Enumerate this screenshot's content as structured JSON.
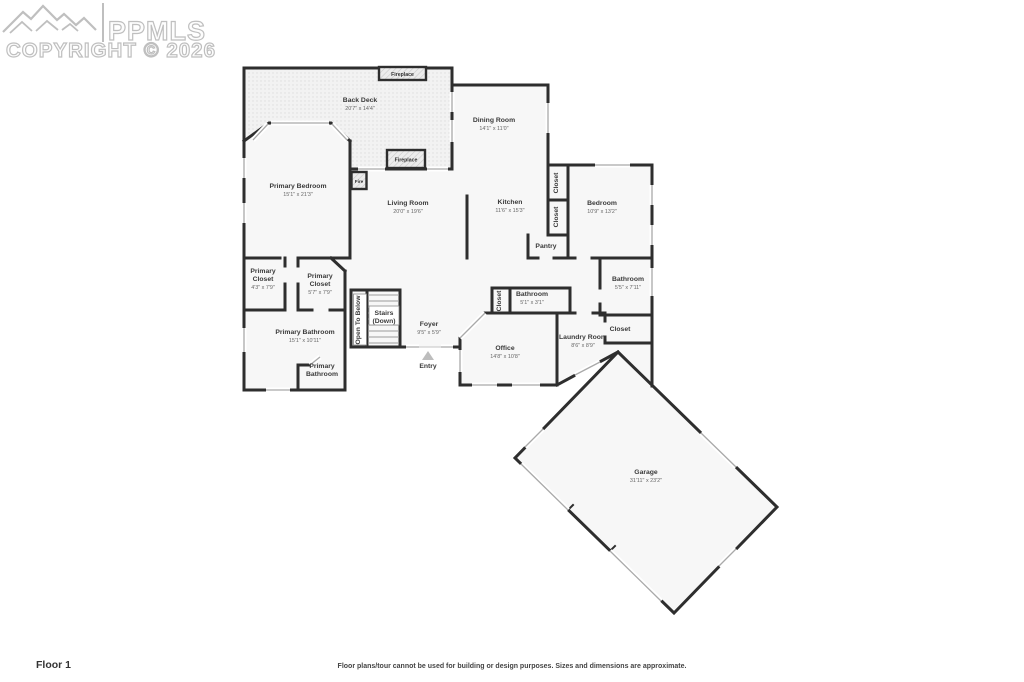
{
  "watermark": {
    "logo_text": "PPMLS",
    "copyright": "COPYRIGHT © 2026"
  },
  "footer": {
    "floor_label": "Floor 1",
    "disclaimer": "Floor plans/tour cannot be used for building or design purposes. Sizes and dimensions are approximate."
  },
  "features": [
    {
      "id": "fireplace-deck",
      "label": "Fireplace"
    },
    {
      "id": "fireplace-living",
      "label": "Fireplace"
    },
    {
      "id": "primary-bedroom-fireplace",
      "label": "Fire"
    }
  ],
  "rooms": [
    {
      "id": "back-deck",
      "x": 360,
      "y": 102,
      "lines": [
        {
          "t": "Back Deck"
        },
        {
          "t": "20'7\" x 14'4\"",
          "d": 1
        }
      ]
    },
    {
      "id": "dining-room",
      "x": 494,
      "y": 122,
      "lines": [
        {
          "t": "Dining Room"
        },
        {
          "t": "14'1\" x 11'0\"",
          "d": 1
        }
      ]
    },
    {
      "id": "primary-bedroom",
      "x": 298,
      "y": 188,
      "lines": [
        {
          "t": "Primary Bedroom"
        },
        {
          "t": "15'1\" x 21'3\"",
          "d": 1
        }
      ]
    },
    {
      "id": "living-room",
      "x": 408,
      "y": 205,
      "lines": [
        {
          "t": "Living Room"
        },
        {
          "t": "20'0\" x 19'6\"",
          "d": 1
        }
      ]
    },
    {
      "id": "kitchen",
      "x": 510,
      "y": 204,
      "lines": [
        {
          "t": "Kitchen"
        },
        {
          "t": "11'6\" x 15'3\"",
          "d": 1
        }
      ]
    },
    {
      "id": "kitchen-closet-upper",
      "x": 558,
      "y": 183,
      "v": 1,
      "lines": [
        {
          "t": "Closet"
        }
      ]
    },
    {
      "id": "kitchen-closet-lower",
      "x": 558,
      "y": 217,
      "v": 1,
      "lines": [
        {
          "t": "Closet"
        }
      ]
    },
    {
      "id": "pantry",
      "x": 546,
      "y": 248,
      "lines": [
        {
          "t": "Pantry"
        }
      ]
    },
    {
      "id": "bedroom",
      "x": 602,
      "y": 205,
      "lines": [
        {
          "t": "Bedroom"
        },
        {
          "t": "10'9\" x 13'2\"",
          "d": 1
        }
      ]
    },
    {
      "id": "bathroom-right",
      "x": 628,
      "y": 281,
      "lines": [
        {
          "t": "Bathroom"
        },
        {
          "t": "5'5\" x 7'11\"",
          "d": 1
        }
      ]
    },
    {
      "id": "closet-right",
      "x": 620,
      "y": 331,
      "lines": [
        {
          "t": "Closet"
        }
      ]
    },
    {
      "id": "primary-closet-left",
      "x": 263,
      "y": 273,
      "lines": [
        {
          "t": "Primary"
        },
        {
          "t": "Closet"
        },
        {
          "t": "4'3\" x 7'9\"",
          "d": 1
        }
      ]
    },
    {
      "id": "primary-closet-right",
      "x": 320,
      "y": 278,
      "lines": [
        {
          "t": "Primary"
        },
        {
          "t": "Closet"
        },
        {
          "t": "5'7\" x 7'9\"",
          "d": 1
        }
      ]
    },
    {
      "id": "open-to-below",
      "x": 360,
      "y": 320,
      "v": 1,
      "lines": [
        {
          "t": "Open To Below"
        }
      ]
    },
    {
      "id": "stairs",
      "x": 384,
      "y": 315,
      "lines": [
        {
          "t": "Stairs"
        },
        {
          "t": "(Down)"
        }
      ]
    },
    {
      "id": "foyer",
      "x": 429,
      "y": 326,
      "lines": [
        {
          "t": "Foyer"
        },
        {
          "t": "9'5\" x 5'9\"",
          "d": 1
        }
      ]
    },
    {
      "id": "entry",
      "x": 428,
      "y": 368,
      "lines": [
        {
          "t": "Entry"
        }
      ]
    },
    {
      "id": "hall-closet",
      "x": 501,
      "y": 301,
      "v": 1,
      "lines": [
        {
          "t": "Closet"
        }
      ]
    },
    {
      "id": "hall-bathroom",
      "x": 532,
      "y": 296,
      "lines": [
        {
          "t": "Bathroom"
        },
        {
          "t": "5'1\" x 3'1\"",
          "d": 1
        }
      ]
    },
    {
      "id": "primary-bathroom",
      "x": 305,
      "y": 334,
      "lines": [
        {
          "t": "Primary Bathroom"
        },
        {
          "t": "15'1\" x 10'11\"",
          "d": 1
        }
      ]
    },
    {
      "id": "primary-bathroom-wc",
      "x": 322,
      "y": 368,
      "lines": [
        {
          "t": "Primary"
        },
        {
          "t": "Bathroom"
        }
      ]
    },
    {
      "id": "office",
      "x": 505,
      "y": 350,
      "lines": [
        {
          "t": "Office"
        },
        {
          "t": "14'8\" x 10'8\"",
          "d": 1
        }
      ]
    },
    {
      "id": "laundry-room",
      "x": 583,
      "y": 339,
      "lines": [
        {
          "t": "Laundry Room"
        },
        {
          "t": "8'6\" x 8'9\"",
          "d": 1
        }
      ]
    },
    {
      "id": "garage",
      "x": 646,
      "y": 474,
      "lines": [
        {
          "t": "Garage"
        },
        {
          "t": "31'11\" x 23'2\"",
          "d": 1
        }
      ]
    }
  ],
  "colors": {
    "wall": "#2e2e2e",
    "room": "#f7f7f7",
    "deck": "#f2f2f2",
    "window": "#a9a9a9",
    "label": "#3a3a3a",
    "dim": "#666666",
    "wm": "#bfbfbf"
  }
}
